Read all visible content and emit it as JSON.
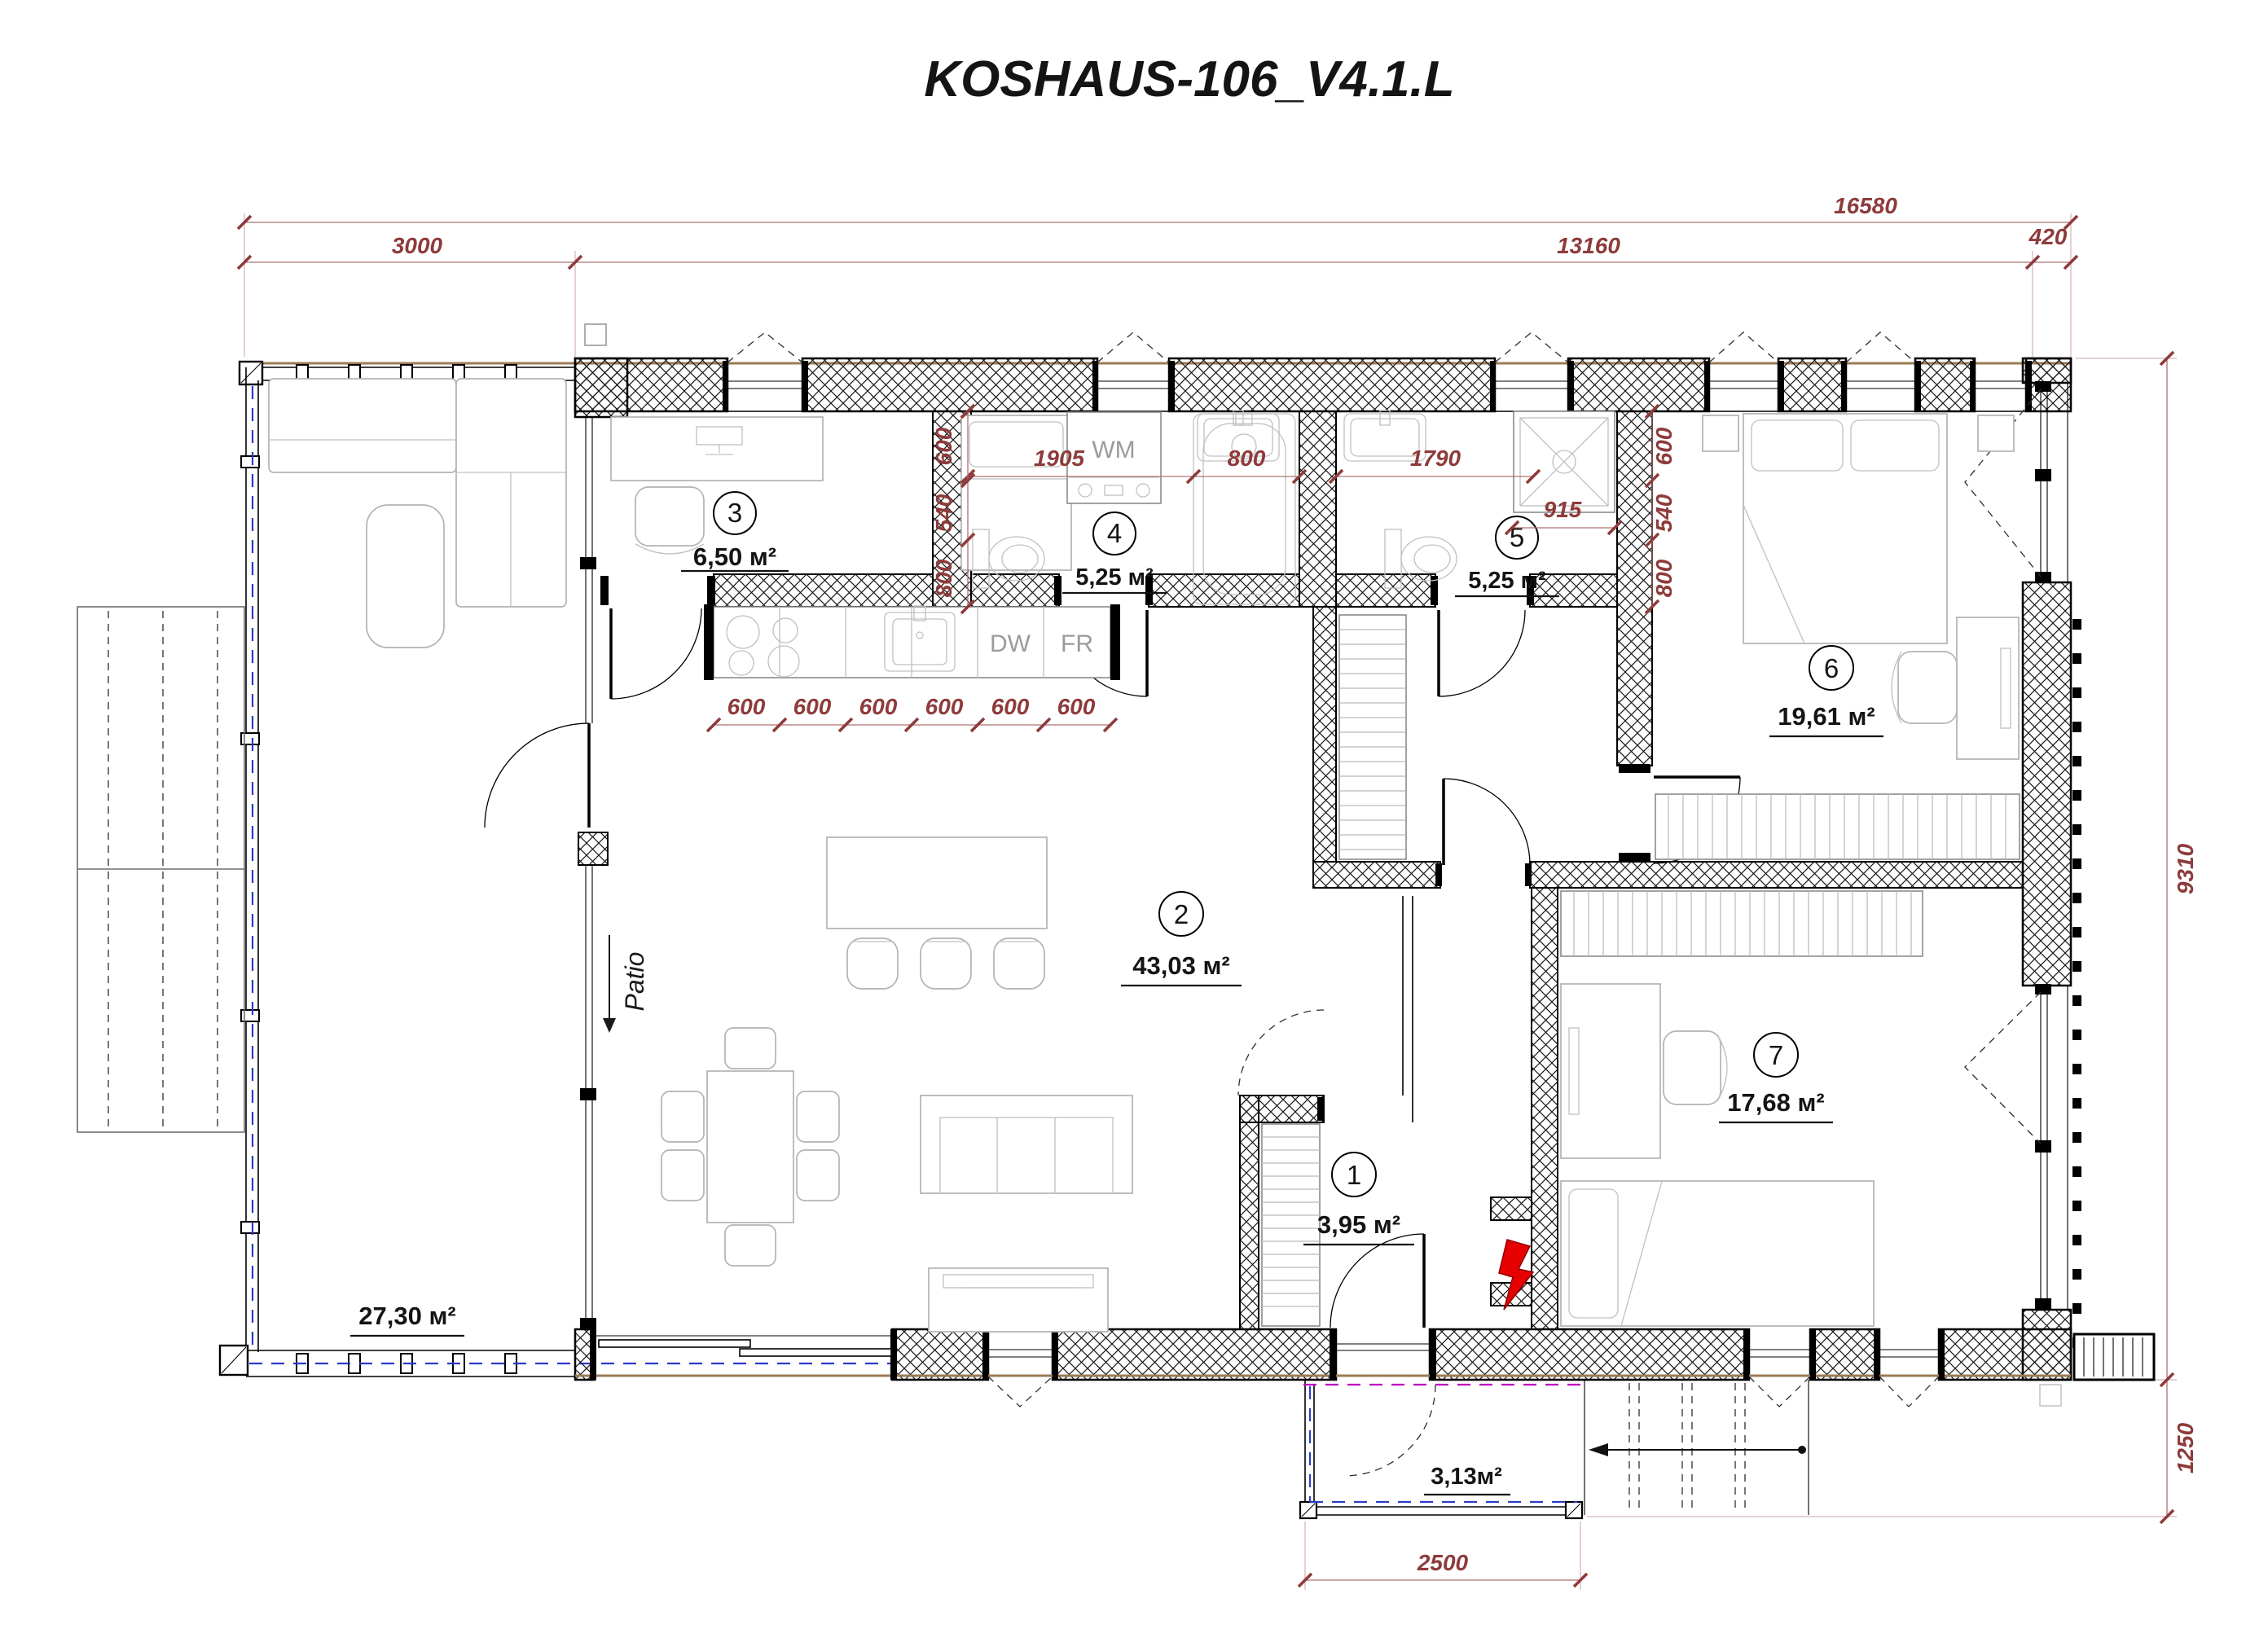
{
  "title": "KOSHAUS-106_V4.1.L",
  "colors": {
    "dimension": "#8e3b3b",
    "terrace_dashed_line": "#2b3cc8",
    "porch_dashed_line": "#bf00bf",
    "electric_symbol": "#e60000",
    "cladding_line": "#9b7b55"
  },
  "dims": {
    "overall_width": "16580",
    "terrace_width": "3000",
    "house_width": "13160",
    "right_offset": "420",
    "house_depth": "9310",
    "porch_depth": "1250",
    "porch_width": "2500",
    "bath4_width": "1905",
    "bath4_tub": "800",
    "bath5_width": "1790",
    "bath5_shower": "915",
    "chain_left": [
      "600",
      "540",
      "800"
    ],
    "chain_right": [
      "600",
      "540",
      "800"
    ],
    "kitchen": [
      "600",
      "600",
      "600",
      "600",
      "600",
      "600"
    ]
  },
  "rooms": [
    {
      "number": "1",
      "area": "3,95 м²"
    },
    {
      "number": "2",
      "area": "43,03 м²"
    },
    {
      "number": "3",
      "area": "6,50 м²"
    },
    {
      "number": "4",
      "area": "5,25 м²"
    },
    {
      "number": "5",
      "area": "5,25 м²"
    },
    {
      "number": "6",
      "area": "19,61 м²"
    },
    {
      "number": "7",
      "area": "17,68 м²"
    }
  ],
  "outdoor": {
    "terrace_area": "27,30 м²",
    "porch_area": "3,13м²",
    "patio": "Patio"
  },
  "appliances": {
    "washing_machine": "WM",
    "oven": "OV",
    "dishwasher": "DW",
    "fridge": "FR"
  }
}
